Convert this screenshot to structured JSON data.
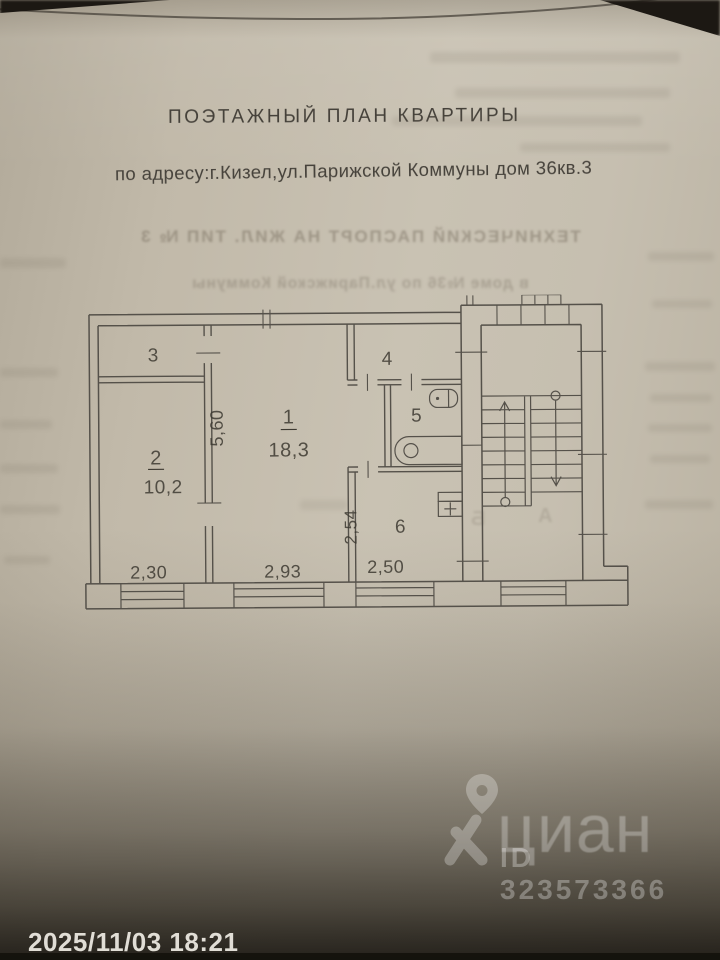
{
  "photo_overlay": {
    "timestamp": "2025/11/03 18:21",
    "watermark": {
      "brand": "циан",
      "listing_id": "ID 323573366"
    }
  },
  "document": {
    "title": "ПОЭТАЖНЫЙ ПЛАН КВАРТИРЫ",
    "address": "по адресу:г.Кизел,ул.Парижской Коммуны дом 36кв.3",
    "bleedthrough": {
      "line1": "ТЕХНИЧЕСКИЙ ПАСПОРТ НА ЖИЛ. ТИП № 3",
      "line2": "в доме №36 по ул.Парижской Коммуны",
      "stair_letter_left": "Б",
      "stair_letter_right": "А"
    }
  },
  "floor_plan": {
    "rooms": [
      {
        "number": "1",
        "area": "18,3"
      },
      {
        "number": "2",
        "area": "10,2"
      },
      {
        "number": "3"
      },
      {
        "number": "4"
      },
      {
        "number": "5"
      },
      {
        "number": "6"
      }
    ],
    "dimensions": {
      "room1_depth": "5,60",
      "room2_front": "2,30",
      "room1_front": "2,93",
      "kitchen_depth": "2,54",
      "kitchen_front": "2,50"
    }
  }
}
